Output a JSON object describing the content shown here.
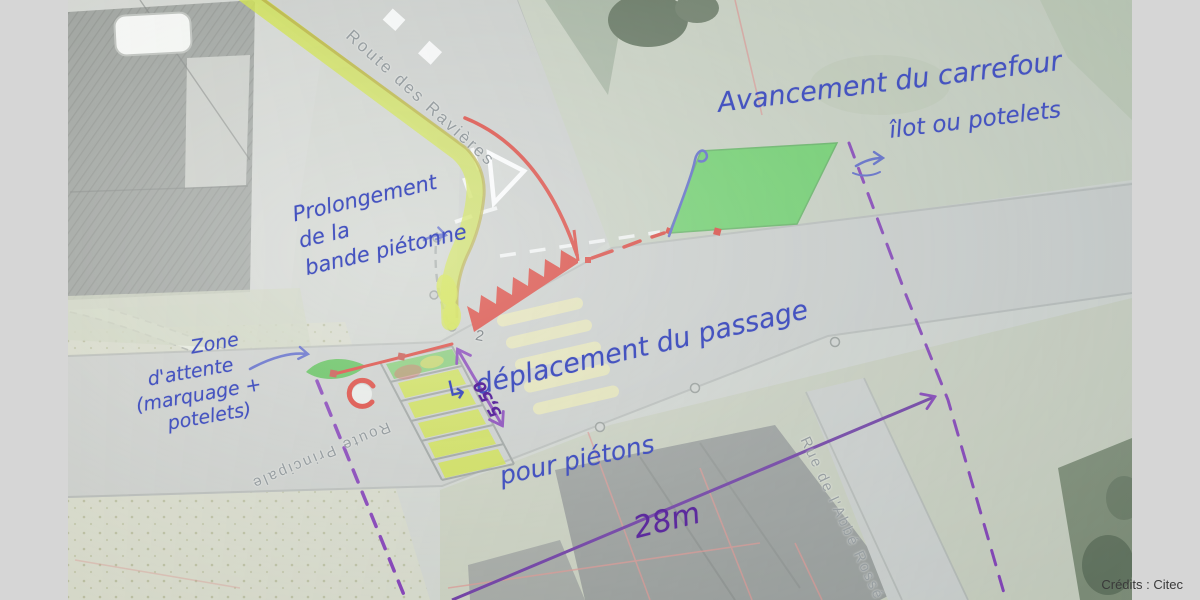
{
  "image": {
    "credits": "Crédits : Citec",
    "base_map_labels": {
      "route_ravieres": "Route des Ravières",
      "route_principale": "Route Principale",
      "rue_abbe_rosse": "Rue de l'Abbé Rossé",
      "house_number": "2"
    },
    "annotations": {
      "avancement": "Avancement du carrefour",
      "ilot": "îlot ou potelets",
      "prolongement_l1": "Prolongement",
      "prolongement_l2": "de la",
      "prolongement_l3": "bande piétonne",
      "zone_l1": "Zone",
      "zone_l2": "d'attente",
      "zone_l3": "(marquage +",
      "zone_l4": "potelets)",
      "deplacement_l1": "↳ déplacement du passage",
      "deplacement_l2": "pour piétons",
      "dim_28m": "28m",
      "dim_550": "5,50"
    },
    "colors": {
      "ink_blue": "#4553c0",
      "ink_purple": "#7325ad",
      "highlight_chartreuse": "#c9de2f",
      "highlight_green": "#3ecb3a",
      "marker_red": "#d8291e",
      "crosswalk_yellow": "#e9e5ac",
      "letterbox_gray": "#d6d6d6"
    }
  }
}
